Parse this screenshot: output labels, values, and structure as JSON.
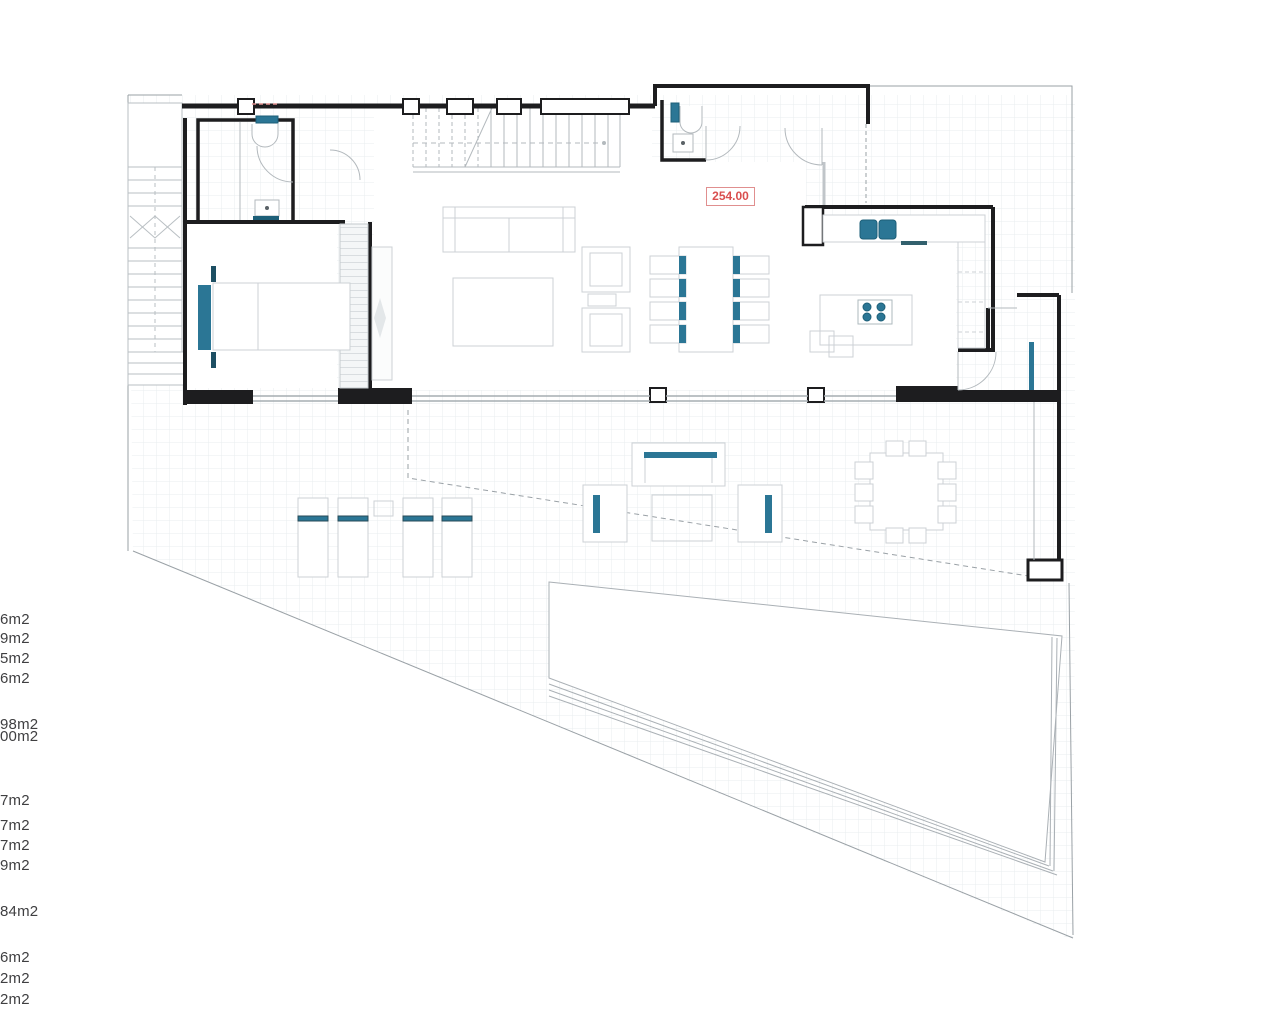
{
  "plan": {
    "type": "architectural floor plan",
    "dimension_label": "254.00",
    "area_labels": [
      "6m2",
      "9m2",
      "5m2",
      "6m2",
      "98m2",
      "00m2",
      "7m2",
      "7m2",
      "7m2",
      "9m2",
      "84m2",
      "6m2",
      "2m2",
      "2m2"
    ],
    "colors": {
      "accent_teal": "#2b7695",
      "accent_teal_dark": "#1d5f78",
      "wall_black": "#1d1d1f",
      "furniture_gray": "#c9ced2",
      "grid_gray": "#e9edef",
      "boundary_gray": "#9aa1a6",
      "dimension_red": "#d94f4f",
      "dimension_red_border": "#e08f8f"
    },
    "features": [
      "exterior-staircase",
      "bathroom",
      "bedroom",
      "wardrobe",
      "interior-staircase",
      "living-room",
      "dining-table",
      "kitchen",
      "kitchen-island",
      "pantry",
      "guest-wc",
      "entry-hall",
      "sun-loungers",
      "outdoor-lounge-set",
      "outdoor-dining-set",
      "pool",
      "site-boundary"
    ]
  }
}
